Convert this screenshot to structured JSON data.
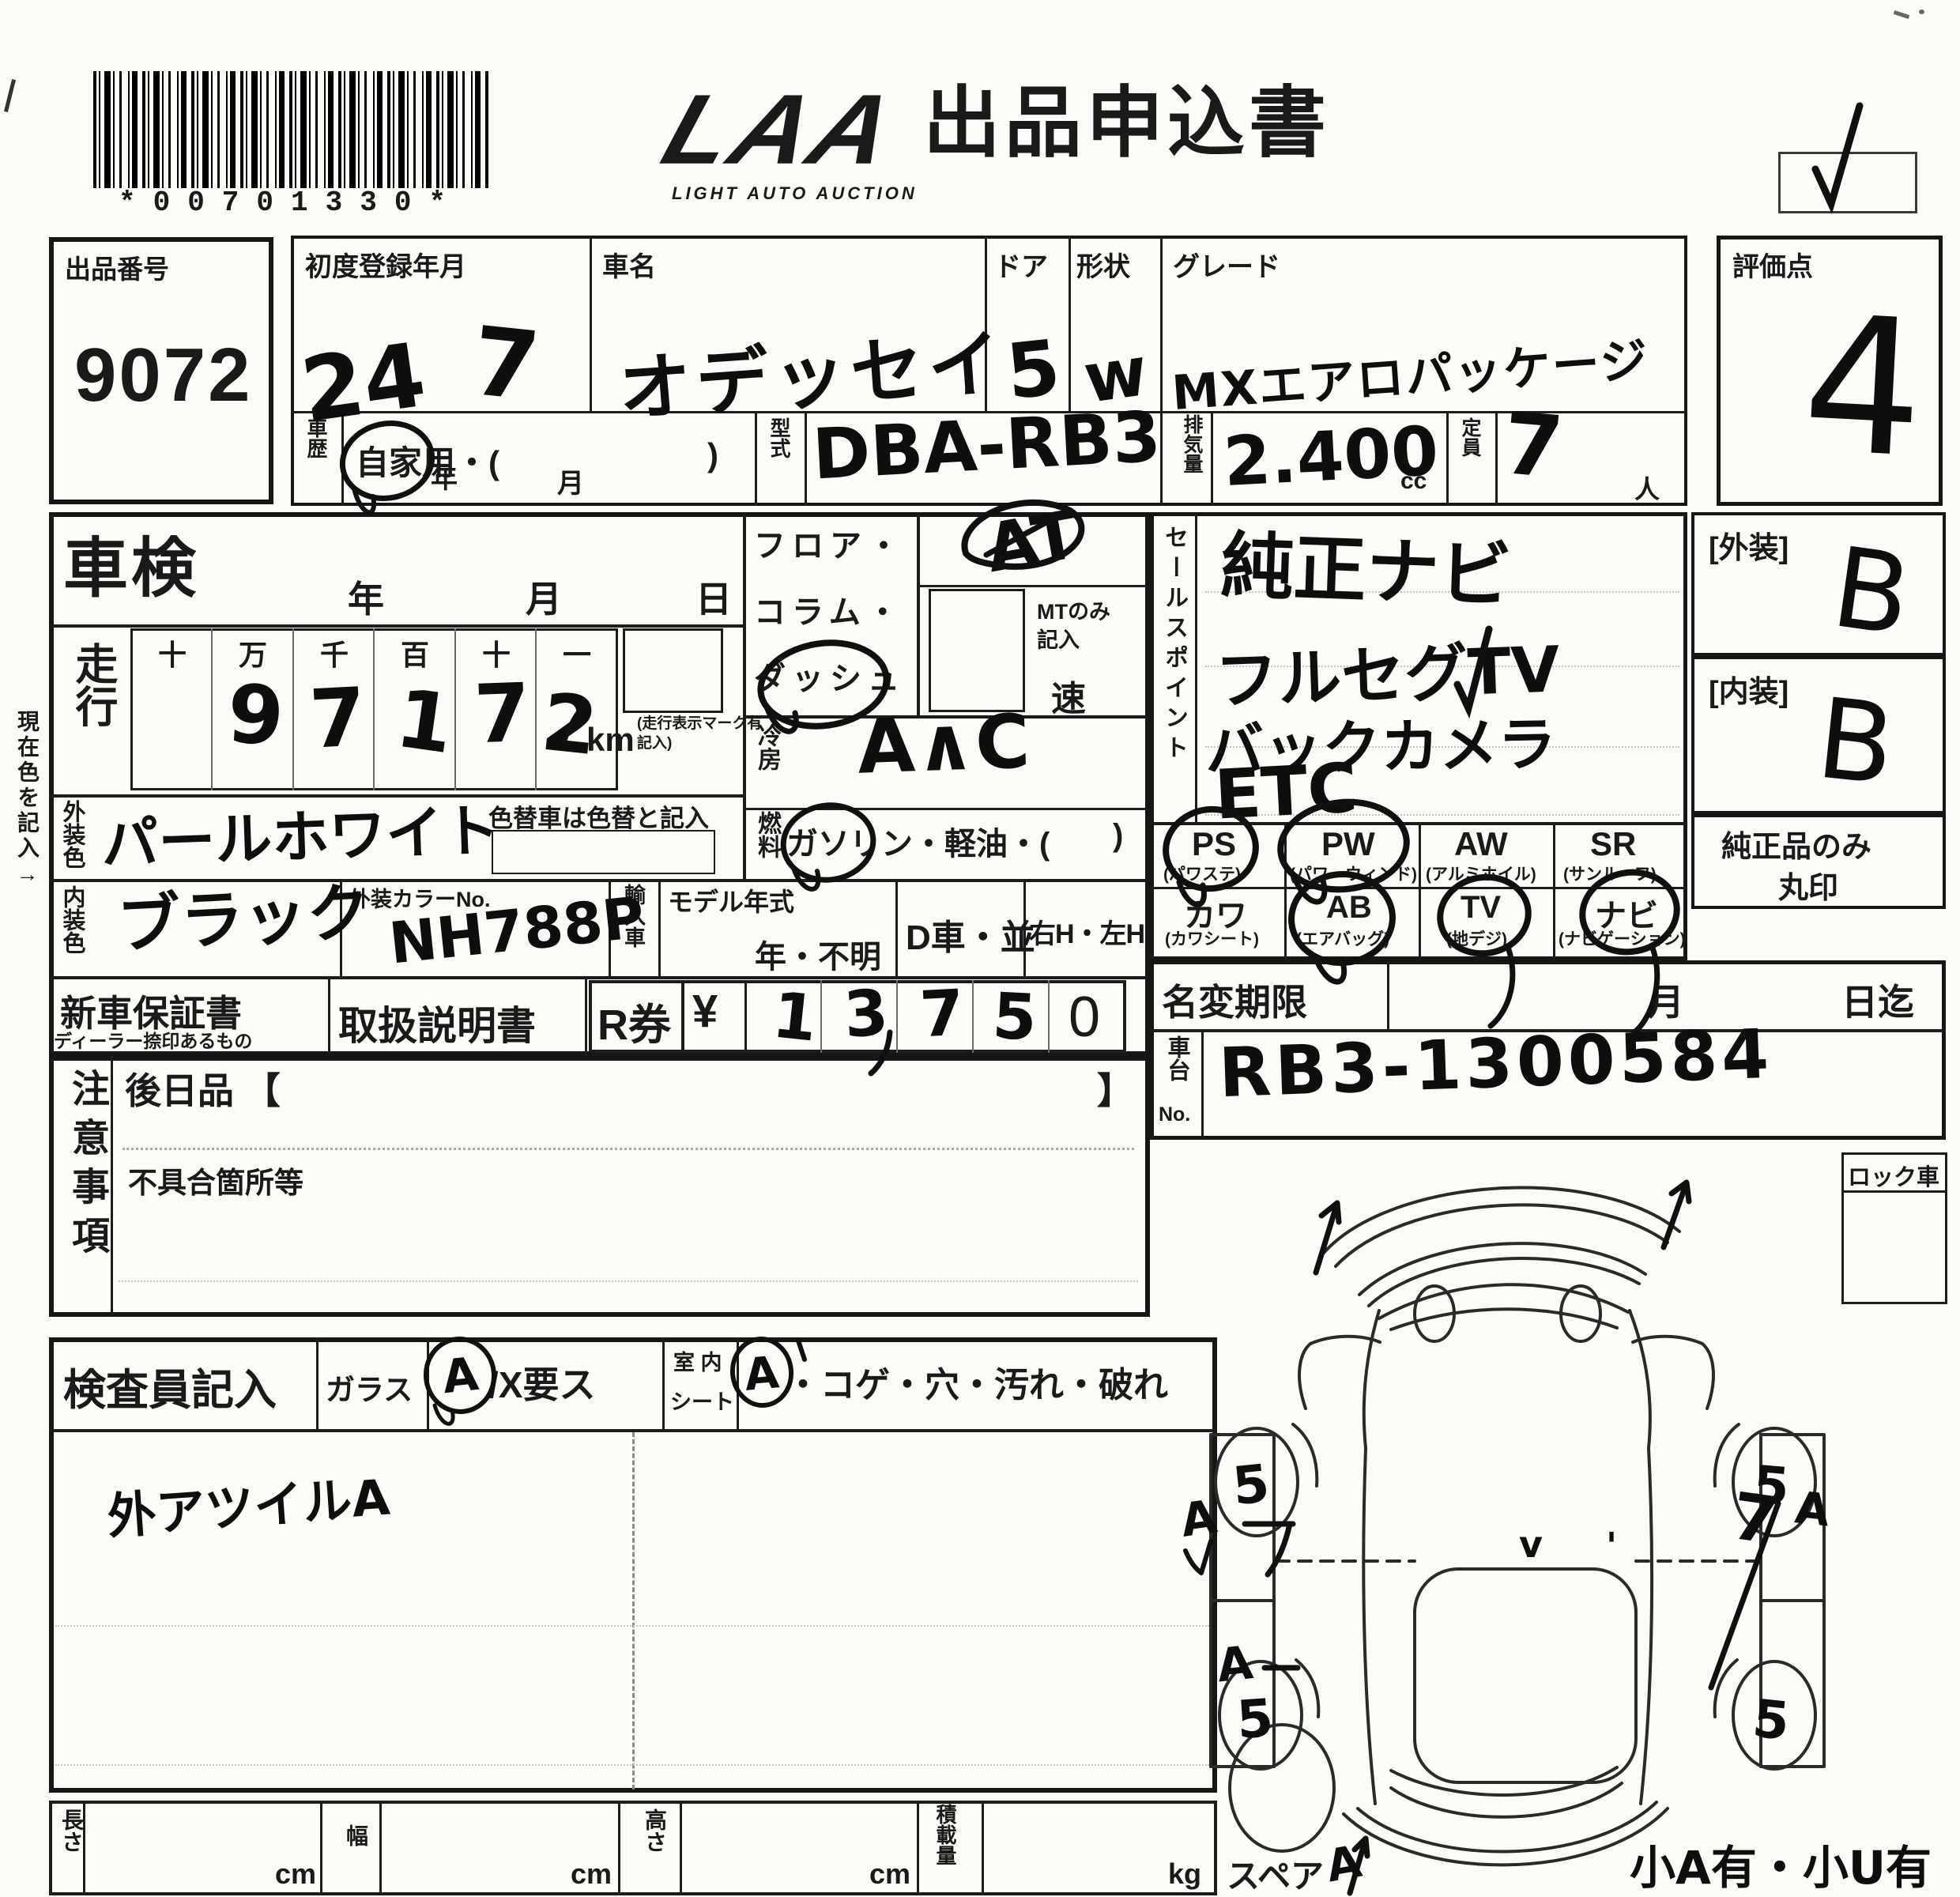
{
  "barcode": {
    "text": "*00701330*"
  },
  "logo": {
    "main": "LAA",
    "sub": "LIGHT AUTO AUCTION"
  },
  "title": "出品申込書",
  "margin_note": "現在色を記入→",
  "lot": {
    "label": "出品番号",
    "value": "9072"
  },
  "reg": {
    "label": "初度登録年月",
    "year": "24",
    "year_unit": "年",
    "month": "7",
    "month_unit": "月"
  },
  "car": {
    "label": "車名",
    "value": "オデッセイ"
  },
  "door": {
    "label": "ドア",
    "value": "5"
  },
  "shape": {
    "label": "形状",
    "value": "w"
  },
  "grade": {
    "label": "グレード",
    "value": "MXエアロパッケージ"
  },
  "history": {
    "label": "車歴",
    "text": "自家用・(",
    "close": ")"
  },
  "model": {
    "label": "型式",
    "value": "DBA-RB3"
  },
  "disp": {
    "label": "排気量",
    "value": "2.400",
    "unit": "cc"
  },
  "capacity": {
    "label": "定員",
    "value": "7",
    "unit": "人"
  },
  "score": {
    "label": "評価点",
    "value": "4"
  },
  "shaken": {
    "label": "車検",
    "year": "年",
    "month": "月",
    "day": "日"
  },
  "mileage": {
    "label": "走行",
    "headers": [
      "十",
      "万",
      "千",
      "百",
      "十",
      "一"
    ],
    "digits": [
      "9",
      "7",
      "1",
      "7",
      "2"
    ],
    "unit": "km",
    "note": "(走行表示マーク有記入)"
  },
  "ext_color": {
    "label": "外装色",
    "value": "パールホワイト",
    "note": "色替車は色替と記入"
  },
  "int_color": {
    "label": "内装色",
    "value": "ブラック"
  },
  "color_no": {
    "label": "外装カラーNo.",
    "value": "NH788P"
  },
  "import_car": {
    "label": "輸入車"
  },
  "model_year": {
    "label": "モデル年式",
    "value": "年・不明"
  },
  "d_car": "D車・並",
  "handle": "右H・左H",
  "trans": {
    "lines": [
      "フロア・",
      "コラム・",
      "ダッシュ"
    ],
    "at": "AT",
    "mt1": "MTのみ",
    "mt2": "記入",
    "speed": "速"
  },
  "ac": {
    "label": "冷房",
    "value": "A∧C"
  },
  "fuel": {
    "label": "燃料",
    "text": "ガソリン・軽油・(",
    "close": ")"
  },
  "sales": {
    "label": "セールスポイント",
    "items": [
      "純正ナビ",
      "フルセグTV",
      "バックカメラ",
      "ETC"
    ]
  },
  "equip": {
    "ps": {
      "code": "PS",
      "name": "(パワステ)"
    },
    "pw": {
      "code": "PW",
      "name": "(パワーウィンド)"
    },
    "aw": {
      "code": "AW",
      "name": "(アルミホイル)"
    },
    "sr": {
      "code": "SR",
      "name": "(サンルーフ)"
    },
    "kawa": {
      "code": "カワ",
      "name": "(カワシート)"
    },
    "ab": {
      "code": "AB",
      "name": "(エアバッグ)"
    },
    "tv": {
      "code": "TV",
      "name": "(地デジ)"
    },
    "navi": {
      "code": "ナビ",
      "name": "(ナビゲーション)"
    }
  },
  "genuine_note": {
    "line1": "純正品のみ",
    "line2": "丸印"
  },
  "ext_grade": {
    "label": "[外装]",
    "value": "B"
  },
  "int_grade": {
    "label": "[内装]",
    "value": "B"
  },
  "warranty": {
    "label": "新車保証書",
    "sub": "ディーラー捺印あるもの"
  },
  "manual": "取扱説明書",
  "r_ticket": {
    "label": "R券",
    "yen": "¥",
    "d1": "1",
    "d2": "3",
    "d3": "7",
    "d4": "5",
    "d5": "0"
  },
  "name_change": {
    "label": "名変期限",
    "month": "月",
    "until": "日迄"
  },
  "chassis": {
    "label1": "車台",
    "label2": "No.",
    "value": "RB3-1300584"
  },
  "lock": "ロック車",
  "notes": {
    "label": "注意事項",
    "later": "後日品 【",
    "close": "】",
    "defects": "不具合箇所等"
  },
  "inspector": {
    "label": "検査員記入",
    "glass": "ガラス",
    "glass_a": "A",
    "glass_rest": "/X要ス",
    "seat1": "室 内",
    "seat2": "シート",
    "seat_a": "A",
    "seat_rest": "・コゲ・穴・汚れ・破れ",
    "note": "外アツイルA"
  },
  "dims": {
    "length": "長さ",
    "width": "幅",
    "height": "高さ",
    "load": "積載量",
    "cm": "cm",
    "kg": "kg"
  },
  "diagram": {
    "spare": "スペア",
    "w1": "5",
    "w2": "5",
    "w3": "5",
    "w4": "5",
    "m7": "7",
    "ma": "A",
    "mv": "v",
    "mc": "'",
    "note": "小A有・小U有"
  }
}
